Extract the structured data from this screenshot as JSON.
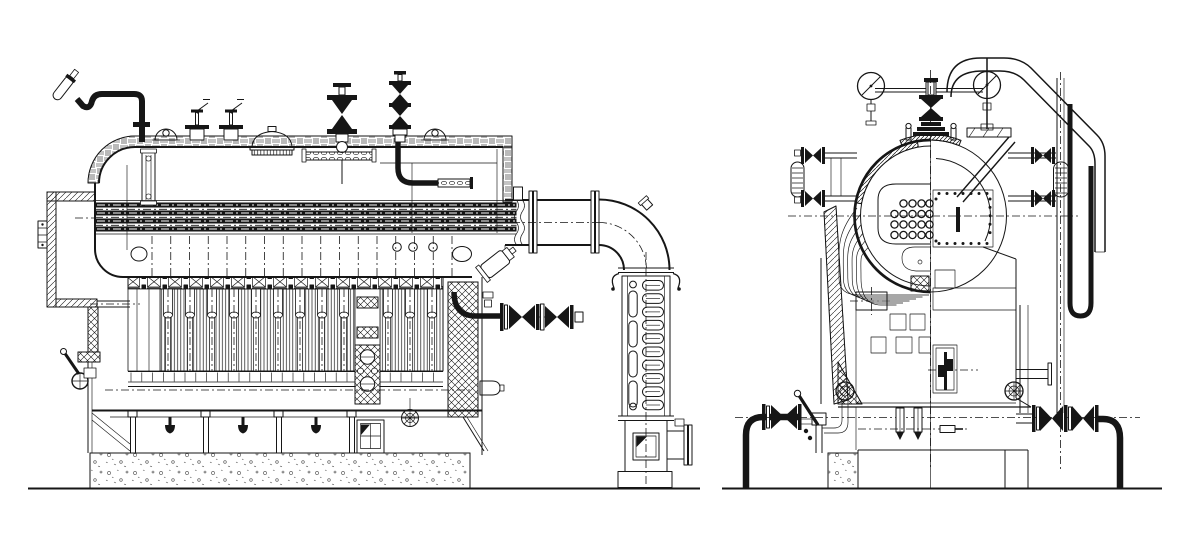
{
  "document": {
    "kind": "technical engineering CAD drawing",
    "subject": "industrial steam boiler general arrangement, two views",
    "views": [
      "side elevation (sectioned)",
      "end elevation (half section)"
    ],
    "paper_color": "#ffffff",
    "ink_color": "#161616",
    "text_labels": []
  },
  "geometry": {
    "water_tube_centerlines": 17,
    "convection_slots": 13,
    "economizer_coils": 10,
    "economizer_left_tubes": 4,
    "tubesheet_rows": [
      4,
      5,
      5,
      5
    ],
    "door_bolts": 22,
    "waterwall_tubes": 6,
    "support_bays": 4,
    "drain_nozzles": 3,
    "pressure_gauges": 2,
    "side_safety_valves": 2
  }
}
